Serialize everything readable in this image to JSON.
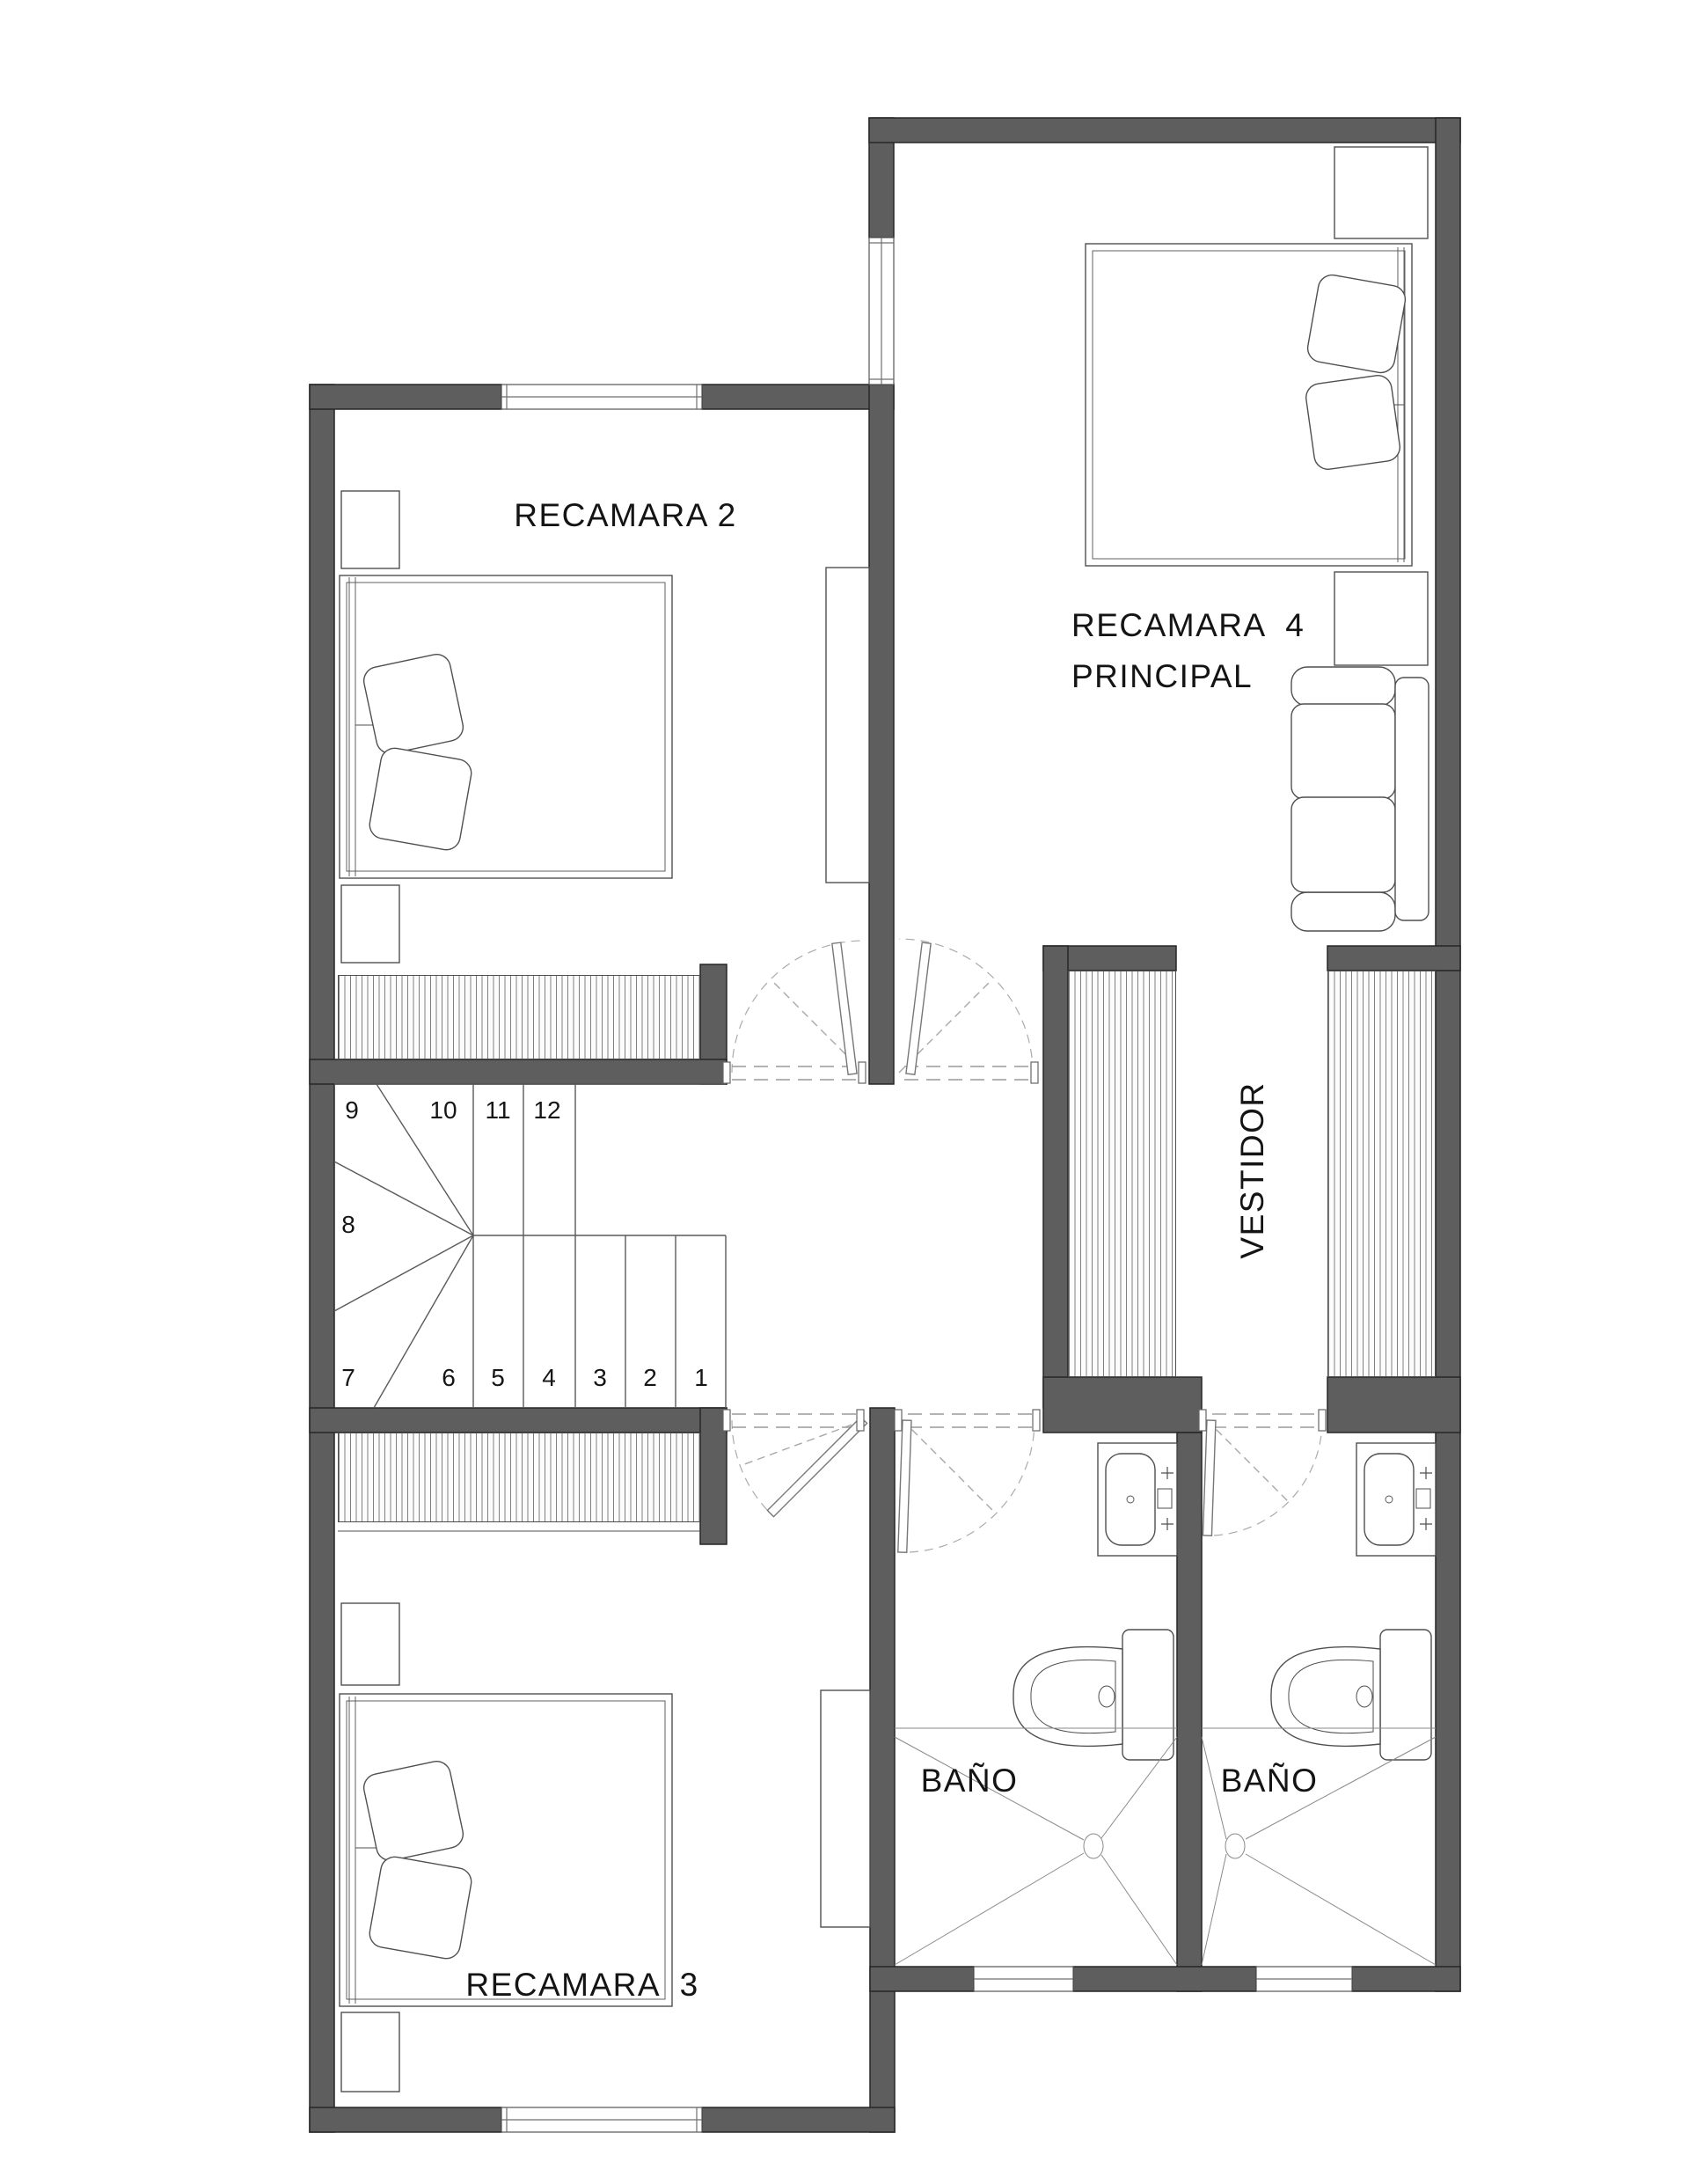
{
  "meta": {
    "drawing_type": "architectural floor plan",
    "floor": "upper level with bedrooms and bathrooms"
  },
  "colors": {
    "wall": "#5e5e5e",
    "wall_outline": "#262626",
    "furniture_line": "#4f4f4f",
    "dash_line": "#a3a3a3",
    "hatch": "#2d2d2d",
    "text": "#141414",
    "background": "#ffffff"
  },
  "rooms": {
    "recamara2": {
      "label": "RECAMARA 2"
    },
    "recamara4": {
      "label_line1": "RECAMARA  4",
      "label_line2": "PRINCIPAL"
    },
    "recamara3": {
      "label": "RECAMARA  3"
    },
    "bano_left": {
      "label": "BAÑO"
    },
    "bano_right": {
      "label": "BAÑO"
    },
    "vestidor": {
      "label": "VESTIDOR"
    }
  },
  "stairs": {
    "steps": [
      "1",
      "2",
      "3",
      "4",
      "5",
      "6",
      "7",
      "8",
      "9",
      "10",
      "11",
      "12"
    ]
  }
}
